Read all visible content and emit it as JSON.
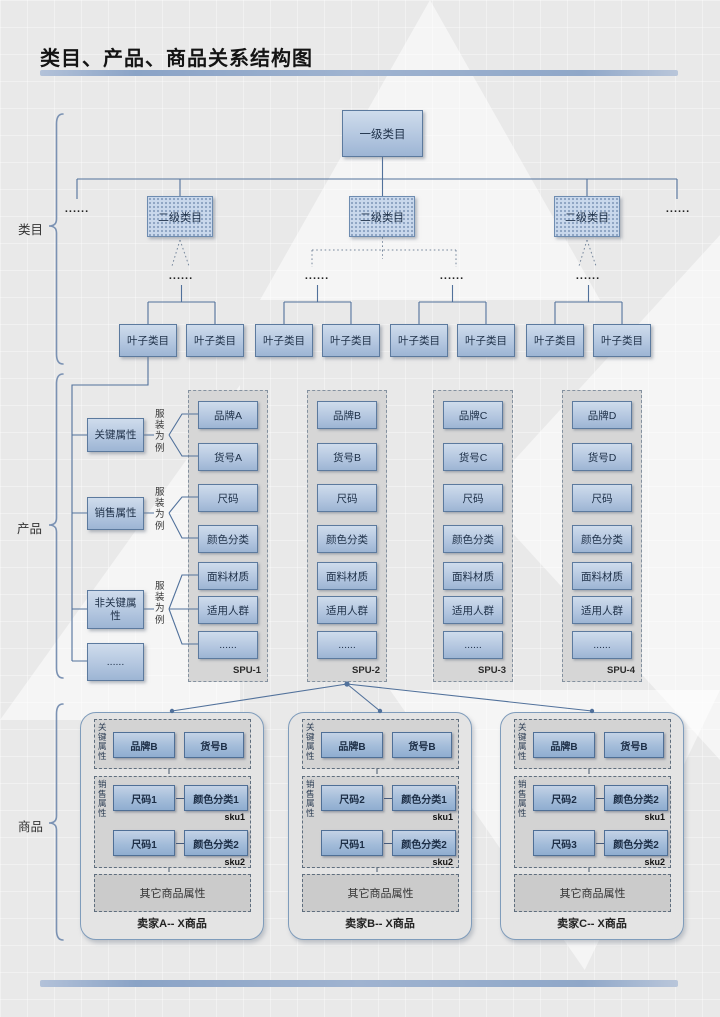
{
  "title": "类目、产品、商品关系结构图",
  "ellipsis": "......",
  "side_labels": {
    "category": "类目",
    "product": "产品",
    "goods": "商品"
  },
  "category_tree": {
    "root": "一级类目",
    "level2": [
      "二级类目",
      "二级类目",
      "二级类目"
    ],
    "leaf": "叶子类目"
  },
  "product_section": {
    "attr_groups": [
      {
        "label": "关键属性",
        "note": "服装为例"
      },
      {
        "label": "销售属性",
        "note": "服装为例"
      },
      {
        "label": "非关键属性",
        "note": "服装为例"
      },
      {
        "label": "......"
      }
    ],
    "spus": [
      {
        "label": "SPU-1",
        "items": [
          "品牌A",
          "货号A",
          "尺码",
          "颜色分类",
          "面料材质",
          "适用人群",
          "......"
        ]
      },
      {
        "label": "SPU-2",
        "items": [
          "品牌B",
          "货号B",
          "尺码",
          "颜色分类",
          "面料材质",
          "适用人群",
          "......"
        ]
      },
      {
        "label": "SPU-3",
        "items": [
          "品牌C",
          "货号C",
          "尺码",
          "颜色分类",
          "面料材质",
          "适用人群",
          "......"
        ]
      },
      {
        "label": "SPU-4",
        "items": [
          "品牌D",
          "货号D",
          "尺码",
          "颜色分类",
          "面料材质",
          "适用人群",
          "......"
        ]
      }
    ]
  },
  "goods_section": {
    "sellers": [
      {
        "name": "卖家A-- X商品",
        "key_label": "关键属性",
        "brand": "品牌B",
        "item_no": "货号B",
        "sales_label": "销售属性",
        "skus": [
          {
            "size": "尺码1",
            "color": "颜色分类1",
            "tag": "sku1"
          },
          {
            "size": "尺码1",
            "color": "颜色分类2",
            "tag": "sku2"
          }
        ],
        "other": "其它商品属性"
      },
      {
        "name": "卖家B-- X商品",
        "key_label": "关键属性",
        "brand": "品牌B",
        "item_no": "货号B",
        "sales_label": "销售属性",
        "skus": [
          {
            "size": "尺码2",
            "color": "颜色分类1",
            "tag": "sku1"
          },
          {
            "size": "尺码1",
            "color": "颜色分类2",
            "tag": "sku2"
          }
        ],
        "other": "其它商品属性"
      },
      {
        "name": "卖家C-- X商品",
        "key_label": "关键属性",
        "brand": "品牌B",
        "item_no": "货号B",
        "sales_label": "销售属性",
        "skus": [
          {
            "size": "尺码2",
            "color": "颜色分类2",
            "tag": "sku1"
          },
          {
            "size": "尺码3",
            "color": "颜色分类2",
            "tag": "sku2"
          }
        ],
        "other": "其它商品属性"
      }
    ]
  },
  "colors": {
    "connector": "#51719b",
    "box_fill": "#b4c7e0",
    "box_border": "#5c7a9e",
    "accent_bar": "#8fa7c8"
  }
}
